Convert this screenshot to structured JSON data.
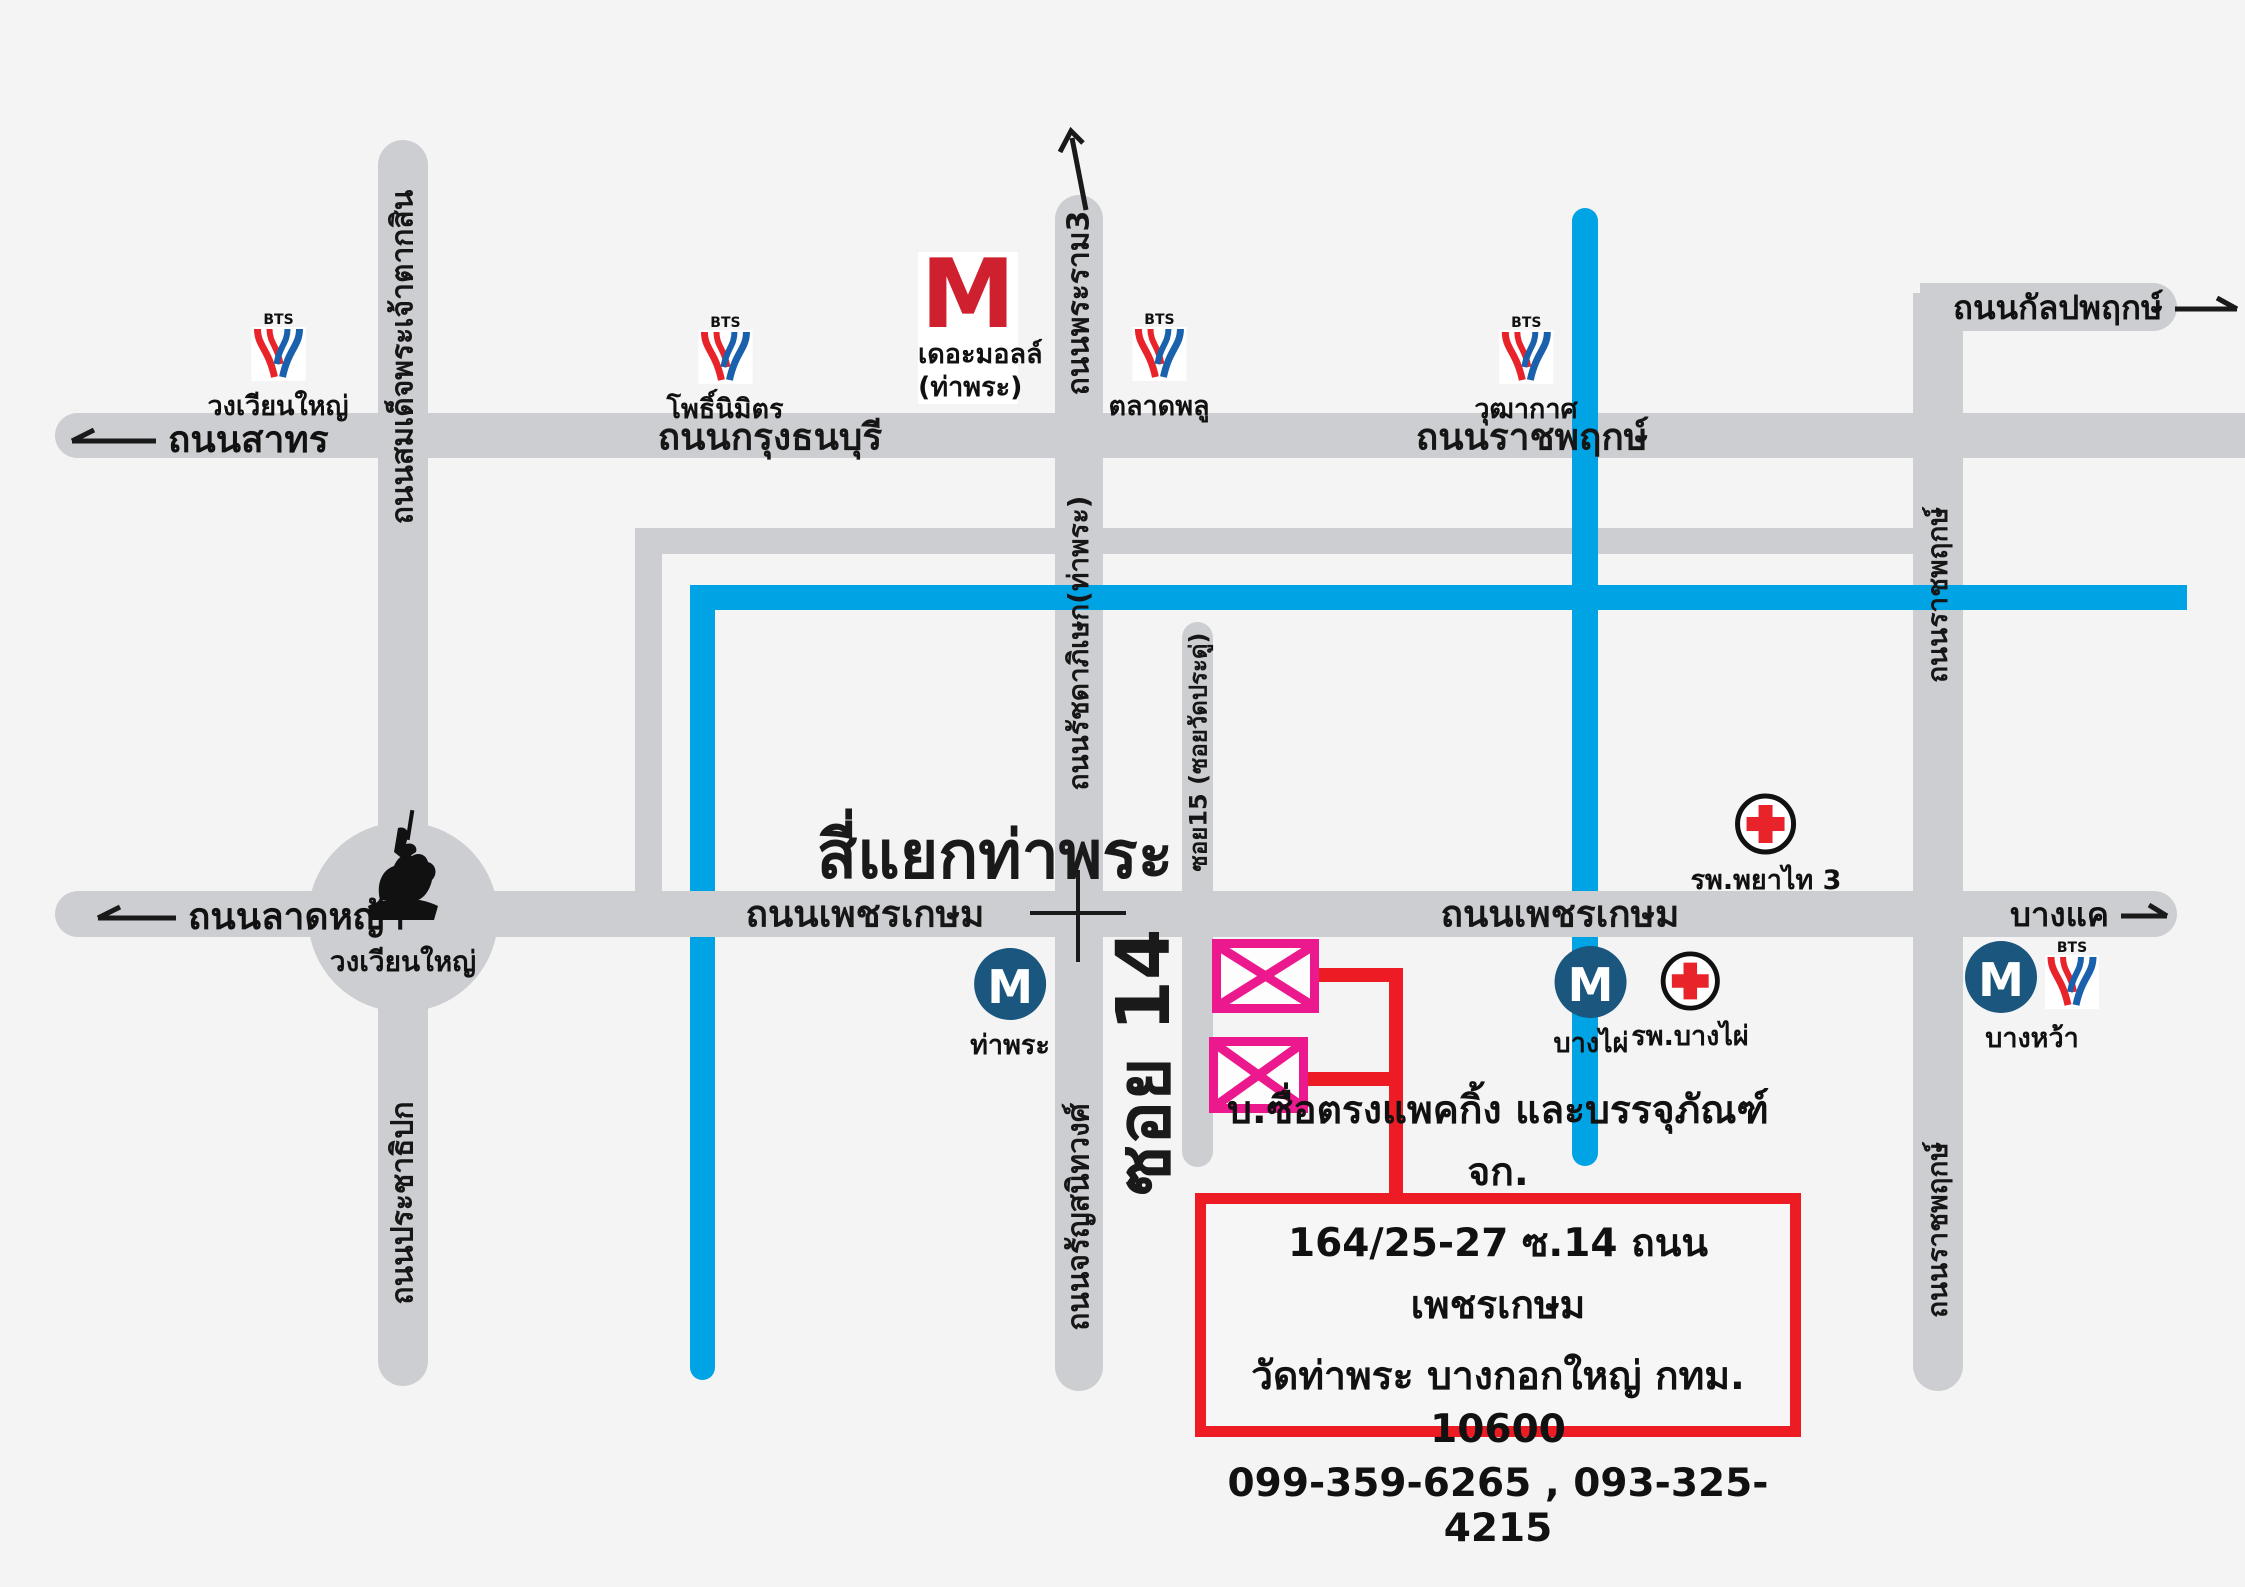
{
  "colors": {
    "background": "#f4f4f5",
    "road": "#cdced1",
    "blue_line": "#00a3e4",
    "pink": "#ec188d",
    "red": "#ed1c24",
    "mrt_blue": "#1a567d",
    "bts_red": "#e8232a",
    "bts_blue": "#1961ac",
    "mall_red": "#cf2030"
  },
  "roads": {
    "sathorn": "ถนนสาทร",
    "krung_thonburi": "ถนนกรุงธนบุรี",
    "ratchaphruek": "ถนนราชพฤกษ์",
    "kanlapaphruek": "ถนนกัลปพฤกษ์",
    "taksin": "ถนนสมเด็จพระเจ้าตากสิน",
    "prachathipok": "ถนนประชาธิปก",
    "phra_ram3": "ถนนพระราม3",
    "ratchadaphisek": "ถนนรัชดาภิเษก(ท่าพระ)",
    "charansanitwong": "ถนนจรัญสนิทวงศ์",
    "soi15": "ซอย15 (ซอยวัดประดู่)",
    "ladya": "ถนนลาดหญ้า",
    "phetkasem_west": "ถนนเพชรเกษม",
    "phetkasem_east": "ถนนเพชรเกษม",
    "bangkhae": "บางแค",
    "ratchaphruek_south_upper": "ถนนราชพฤกษ์",
    "ratchaphruek_south_lower": "ถนนราชพฤกษ์",
    "soi14": "ซอย 14"
  },
  "junction": {
    "title": "สี่แยกท่าพระ",
    "roundabout": "วงเวียนใหญ่"
  },
  "bts": {
    "brand": "BTS",
    "stations": {
      "wongwian_yai": "วงเวียนใหญ่",
      "pho_nimit": "โพธิ์นิมิตร",
      "talat_phlu": "ตลาดพลู",
      "wutthakat": "วุฒากาศ"
    }
  },
  "mrt": {
    "initial": "M",
    "stations": {
      "tha_phra": "ท่าพระ",
      "bang_phai": "บางไผ่",
      "bang_wa": "บางหว้า"
    }
  },
  "mall": {
    "initial": "M",
    "name": "เดอะมอลล์",
    "branch": "(ท่าพระ)"
  },
  "hospitals": {
    "phayathai3": "รพ.พยาไท 3",
    "bang_phai": "รพ.บางไผ่"
  },
  "info_box": {
    "line1": "บ.ซื่อตรงแพคกิ้ง และบรรจุภัณฑ์ จก.",
    "line2": "164/25-27 ซ.14 ถนนเพชรเกษม",
    "line3": "วัดท่าพระ บางกอกใหญ่ กทม. 10600",
    "line4": "099-359-6265 , 093-325-4215"
  }
}
